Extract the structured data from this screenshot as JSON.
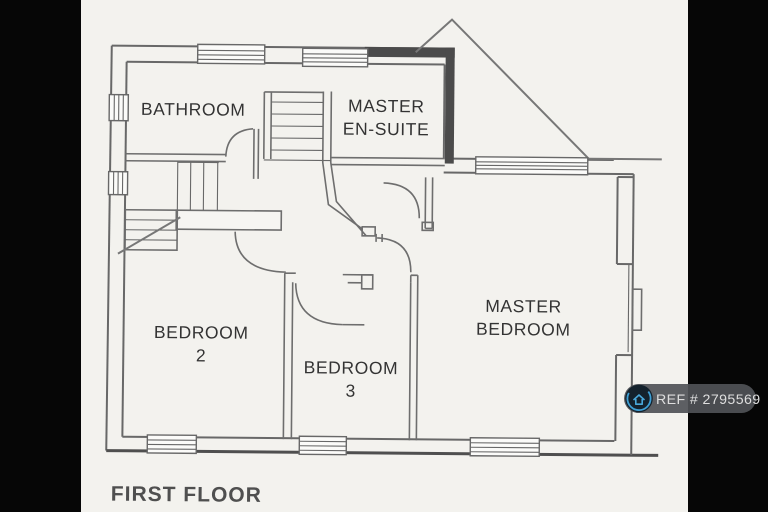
{
  "image": {
    "kind": "scanned floor plan photo with letterbox bars",
    "bar_color": "#060606",
    "paper_color": "#f3f2ee"
  },
  "plan": {
    "floor_label": "FIRST FLOOR",
    "rooms": [
      {
        "id": "bathroom",
        "lines": [
          "BATHROOM",
          ""
        ]
      },
      {
        "id": "master-ensuite",
        "lines": [
          "MASTER",
          "EN-SUITE"
        ]
      },
      {
        "id": "bedroom-2",
        "lines": [
          "BEDROOM",
          "2"
        ]
      },
      {
        "id": "bedroom-3",
        "lines": [
          "BEDROOM",
          "3"
        ]
      },
      {
        "id": "master-bedroom",
        "lines": [
          "MASTER",
          "BEDROOM"
        ]
      }
    ]
  },
  "watermark": {
    "ref_text": "REF # 2795569",
    "pill_color": "#505357",
    "text_color": "#dedede",
    "icon": "house-logo-icon",
    "icon_ring_color": "#3f9fd4",
    "icon_bg_color": "#14222d"
  },
  "colors": {
    "wall_line": "#686868",
    "dark_wall": "#4b4b4b",
    "label_text": "#333333",
    "floor_label_text": "#4f4f4f"
  }
}
